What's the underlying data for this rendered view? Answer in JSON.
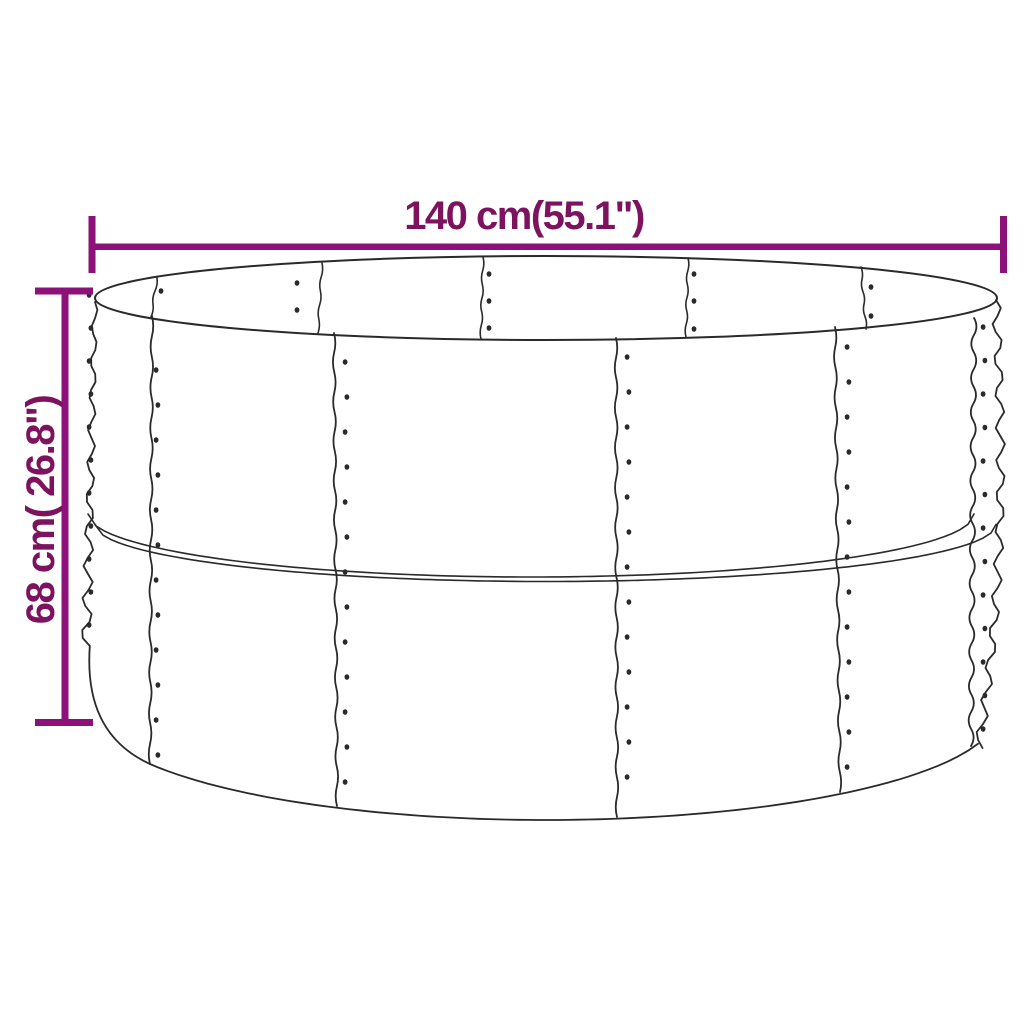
{
  "diagram": {
    "width_label": "140 cm(55.1\")",
    "height_label": "68 cm( 26.8\")"
  },
  "colors": {
    "dimension_line": "#8c1279",
    "dimension_text": "#7d135f",
    "artwork_line": "#2a2a2a",
    "background": "#ffffff"
  }
}
